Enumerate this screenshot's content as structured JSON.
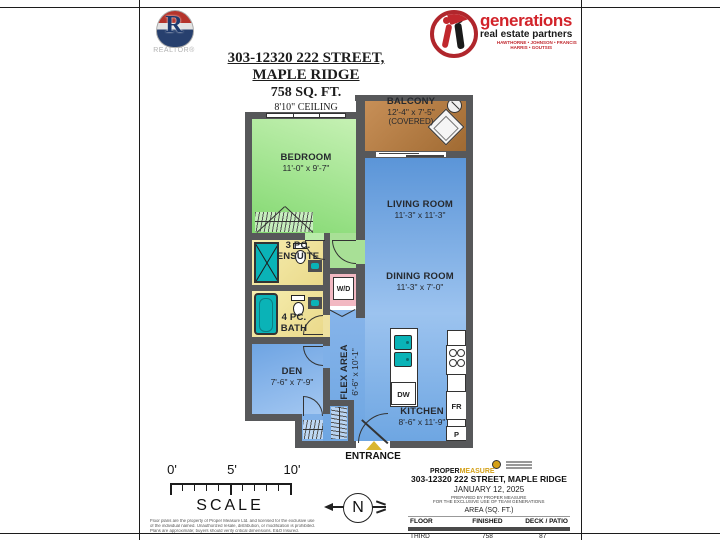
{
  "header": {
    "realtor_label": "REALTOR®",
    "brand": {
      "name": "generations",
      "tagline": "real estate partners",
      "agents_line1": "HAWTHORNE • JOHNSON • FRANCIS",
      "agents_line2": "HARRIS • GOUTSIS"
    },
    "title_line1": "303-12320 222 STREET,",
    "title_line2": "MAPLE RIDGE",
    "title_line3": "758 SQ. FT.",
    "title_line4": "8'10\" CEILING"
  },
  "floorplan": {
    "rooms": [
      {
        "name": "BALCONY",
        "dims": "12'-4\" x 7'-5\"",
        "note": "(COVERED)"
      },
      {
        "name": "BEDROOM",
        "dims": "11'-0\" x 9'-7\""
      },
      {
        "name": "LIVING ROOM",
        "dims": "11'-3\" x 11'-3\""
      },
      {
        "name": "DINING ROOM",
        "dims": "11'-3\" x 7'-0\""
      },
      {
        "l1": "3 PC.",
        "l2": "ENSUITE"
      },
      {
        "l1": "4 PC.",
        "l2": "BATH"
      },
      {
        "name": "DEN",
        "dims": "7'-6\" x 7'-9\""
      },
      {
        "name": "FLEX AREA",
        "dims": "6'-6\" x 10'-1\""
      },
      {
        "name": "KITCHEN",
        "dims": "8'-6\" x 11'-9\""
      }
    ],
    "appliances": {
      "washer_dryer": "W/D",
      "dishwasher": "DW",
      "fridge": "FR",
      "pantry": "P"
    },
    "entrance_label": "ENTRANCE"
  },
  "scale_bar": {
    "tick_labels": [
      "0'",
      "5'",
      "10'"
    ],
    "label": "SCALE",
    "disclaimer_lines": [
      "Floor plans are the property of Proper Measure Ltd. and licensed for the exclusive use",
      "of the individual named. Unauthorized resale, distribution, or modification is prohibited.",
      "Plans are approximate; buyers should verify critical dimensions. E&O Insured."
    ]
  },
  "compass": {
    "north": "N"
  },
  "info_panel": {
    "logo": {
      "word1": "PROPER",
      "word2": "MEASURE"
    },
    "address": "303-12320 222 STREET, MAPLE RIDGE",
    "date": "JANUARY 12, 2025",
    "prepared_line1": "PREPARED BY PROPER MEASURE",
    "prepared_line2": "FOR THE EXCLUSIVE USE OF TEAM GENERATIONS",
    "area_heading": "AREA (SQ. FT.)",
    "table": {
      "headers": [
        "FLOOR",
        "FINISHED",
        "DECK / PATIO"
      ],
      "rows": [
        [
          "THIRD",
          "758",
          "87"
        ]
      ]
    }
  },
  "colors": {
    "wall": "#57585a",
    "bedroom_green": "#9ae288",
    "living_blue": "#7fb0e8",
    "balcony_brown": "#b5793f",
    "bath_yellow": "#f2e9a4",
    "laundry_pink": "#f2b8c2",
    "fixture_teal": "#0ab3b7",
    "brand_red": "#d2232a",
    "entrance_arrow": "#d9b630"
  }
}
